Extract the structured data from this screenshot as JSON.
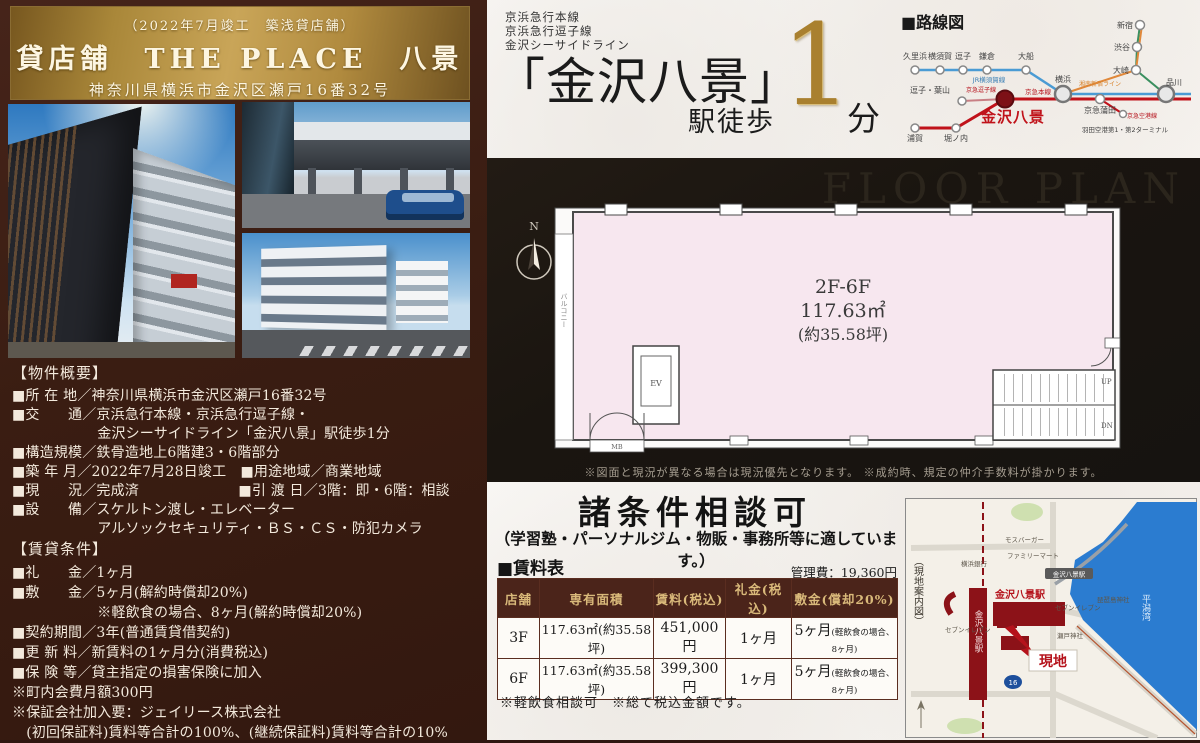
{
  "header": {
    "note": "（2022年7月竣工　築浅貸店舗）",
    "title": "貸店舗　THE PLACE　八景",
    "address": "神奈川県横浜市金沢区瀬戸16番32号"
  },
  "access": {
    "lines": [
      "京浜急行本線",
      "京浜急行逗子線",
      "金沢シーサイドライン"
    ],
    "station": "「金沢八景」",
    "walk": "駅徒歩",
    "minutes": "1",
    "unit": "分"
  },
  "routemap": {
    "title": "■路線図",
    "stations": {
      "kurihama": "久里浜",
      "yokosuka": "横須賀",
      "zushi": "逗子",
      "kamakura": "鎌倉",
      "ofuna": "大船",
      "zushi_hayama": "逗子・葉山",
      "uraga": "浦賀",
      "horinouchi": "堀ノ内",
      "yokohama": "横浜",
      "keikyu_kamata": "京急蒲田",
      "shinagawa": "品川",
      "osaki": "大崎",
      "shibuya": "渋谷",
      "shinjuku": "新宿",
      "haneda": "羽田空港第1・第2ターミナル",
      "kanazawa_hakkei": "金沢八景"
    },
    "lines": {
      "yokosuka_line": "JR横須賀線",
      "zushi_line": "京急逗子線",
      "main_line": "京急本線",
      "shonan_shinjuku": "湘南新宿ライン",
      "airport_line": "京急空港線"
    }
  },
  "floorplan": {
    "watermark": "FLOOR PLAN",
    "floors": "2F-6F",
    "area": "117.63㎡",
    "tsubo": "(約35.58坪)",
    "balcony": "バルコニー",
    "ev": "EV",
    "mb": "MB",
    "up": "UP",
    "dn": "DN",
    "north": "N",
    "note": "※図面と現況が異なる場合は現況優先となります。 ※成約時、規定の仲介手数料が掛かります。"
  },
  "overview": {
    "title": "【物件概要】",
    "lines": [
      "■所 在 地／神奈川県横浜市金沢区瀬戸16番32号",
      "■交　　通／京浜急行本線・京浜急行逗子線・",
      "　　　　　　金沢シーサイドライン「金沢八景」駅徒歩1分",
      "■構造規模／鉄骨造地上6階建3・6階部分",
      "■築 年 月／2022年7月28日竣工　■用途地域／商業地域",
      "■現　　況／完成済　　　　　　　■引 渡 日／3階：即・6階：相談",
      "■設　　備／スケルトン渡し・エレベーター",
      "　　　　　　アルソックセキュリティ・ＢＳ・ＣＳ・防犯カメラ"
    ]
  },
  "terms": {
    "title": "【賃貸条件】",
    "lines": [
      "■礼　　金／1ヶ月",
      "■敷　　金／5ヶ月(解約時償却20%)",
      "　　　　　　※軽飲食の場合、8ヶ月(解約時償却20%)",
      "■契約期間／3年(普通賃貸借契約)",
      "■更 新 料／新賃料の1ヶ月分(消費税込)",
      "■保 険 等／貸主指定の損害保険に加入",
      "※町内会費月額300円",
      "※保証会社加入要：ジェイリース株式会社",
      "　(初回保証料)賃料等合計の100%、(継続保証料)賃料等合計の10%"
    ]
  },
  "conditions": {
    "title": "諸条件相談可",
    "subtitle": "（学習塾・パーソナルジム・物販・事務所等に適しています。）"
  },
  "rent_table": {
    "title": "■賃料表",
    "management_fee": "管理費：19,360円",
    "headers": [
      "店舗",
      "専有面積",
      "賃料(税込)",
      "礼金(税込)",
      "敷金(償却20%)"
    ],
    "rows": [
      {
        "floor": "3F",
        "area": "117.63㎡(約35.58坪)",
        "rent": "451,000円",
        "key_money": "1ヶ月",
        "deposit": "5ヶ月",
        "deposit_note": "(軽飲食の場合、8ヶ月)"
      },
      {
        "floor": "6F",
        "area": "117.63㎡(約35.58坪)",
        "rent": "399,300円",
        "key_money": "1ヶ月",
        "deposit": "5ヶ月",
        "deposit_note": "(軽飲食の場合、8ヶ月)"
      }
    ],
    "notes": "※軽飲食相談可　※総て税込金額です。"
  },
  "map": {
    "caption": "（現地案内図）",
    "station": "金沢八景駅",
    "seaside_station": "金沢八景駅",
    "site": "現地",
    "bay": "平潟湾",
    "shield": "16",
    "labels": {
      "mos": "モスバーガー",
      "famima": "ファミリーマート",
      "bank": "横浜銀行",
      "seven1": "セブンイレブン",
      "seven2": "セブンイレブン",
      "biwajima": "琵琶島神社",
      "seto": "瀬戸神社"
    }
  },
  "colors": {
    "gold": "#c9a558",
    "panel_brown": "#3a1d12",
    "accent_red": "#b5121b",
    "table_header": "#4b241a",
    "water_blue": "#2b7cd0",
    "plan_pink": "#f7e7ef"
  }
}
